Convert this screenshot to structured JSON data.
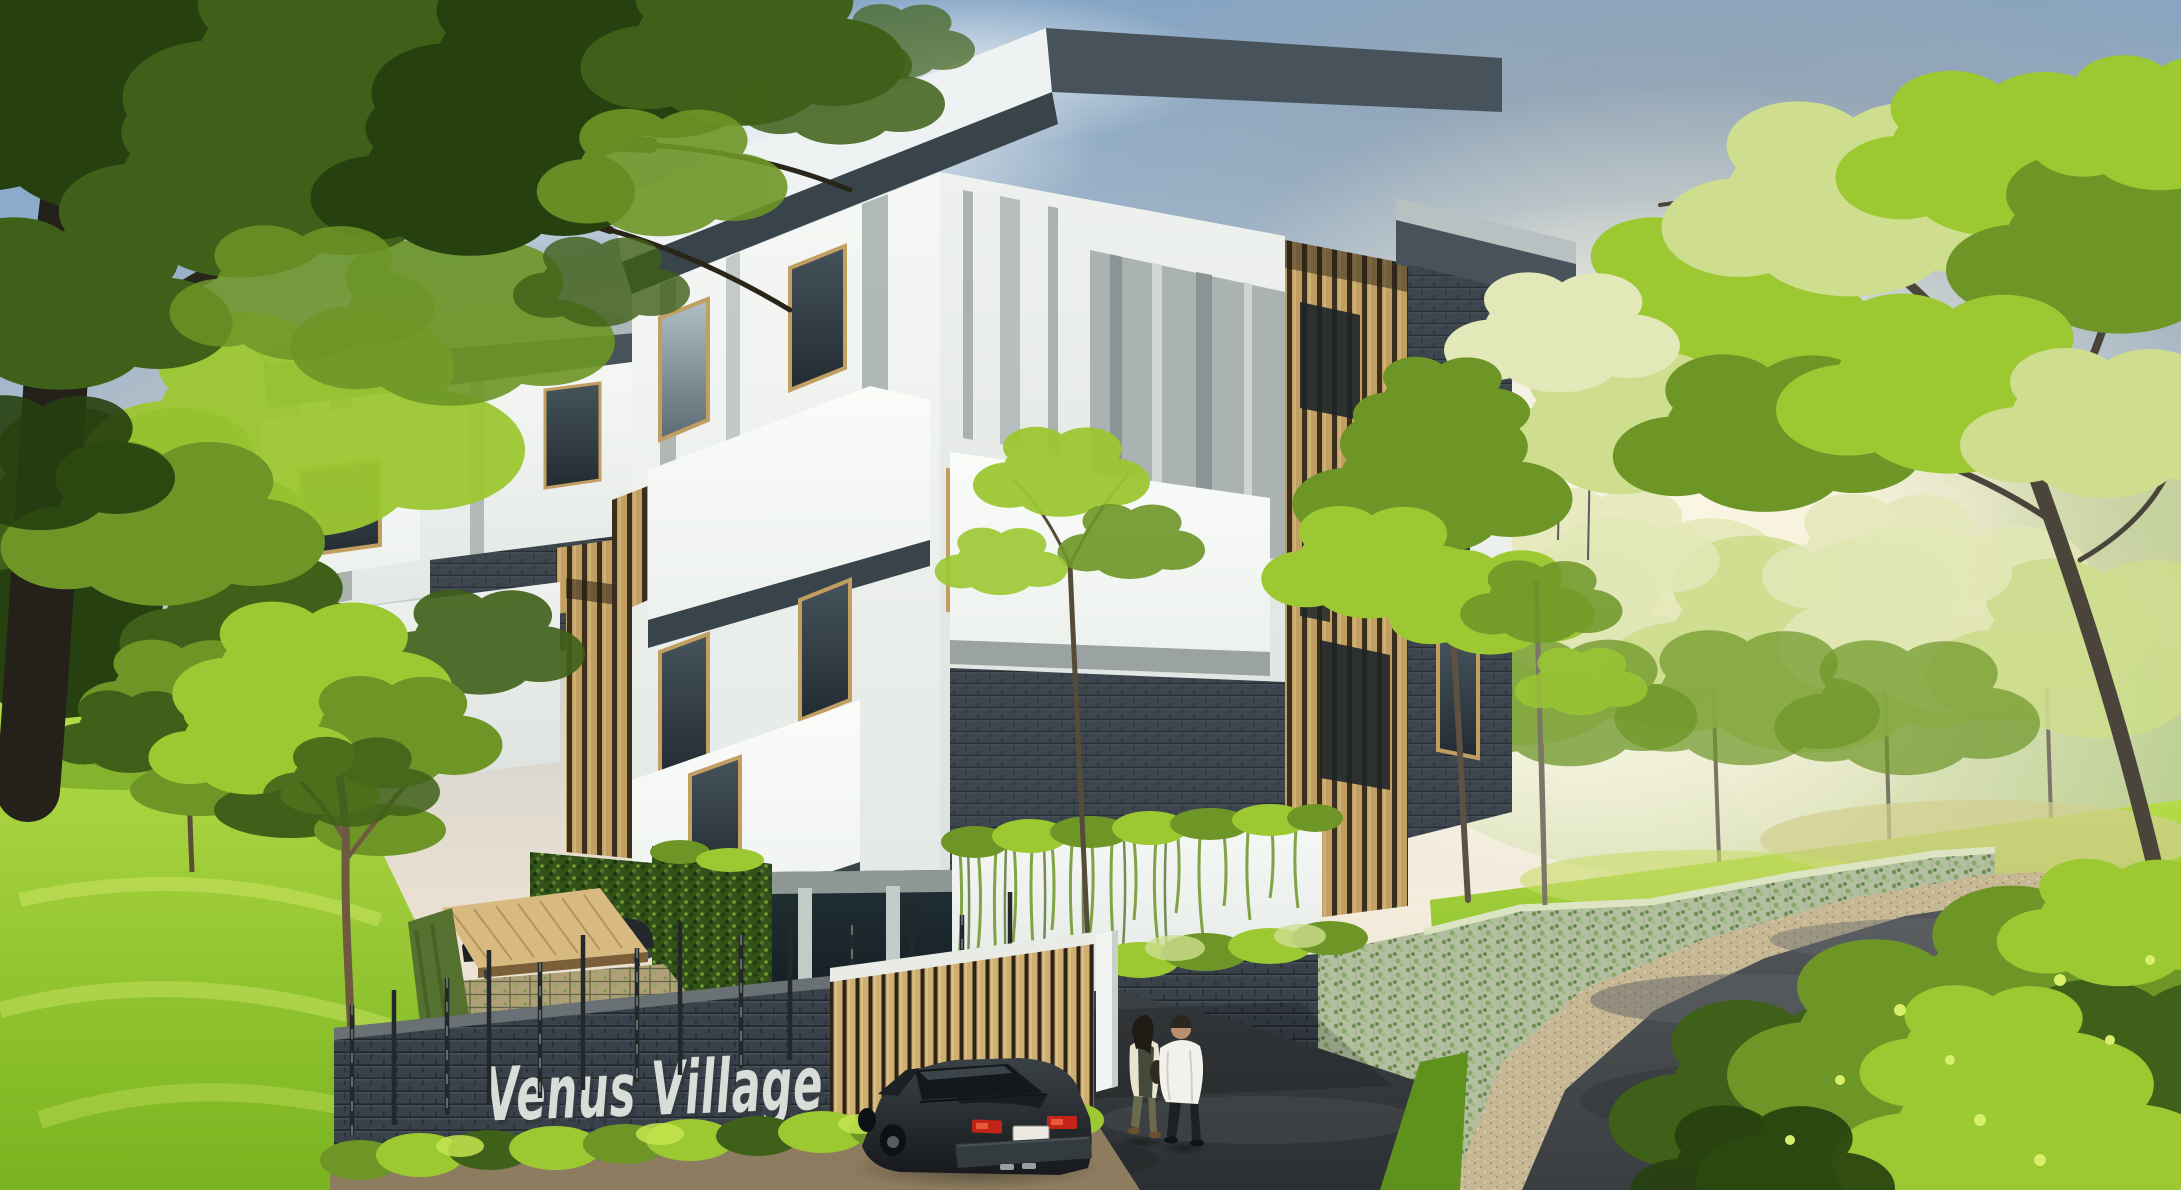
{
  "scene": {
    "title": "Venus Village residential complex - exterior architectural rendering",
    "sign_text": "Venus Village",
    "time_of_day": "daytime with hazy sun glow on the right"
  },
  "elements": [
    {
      "name": "sky",
      "desc": "blue sky upper-left fading to warm grey haze"
    },
    {
      "name": "clouds",
      "desc": "white and pink soft clouds"
    },
    {
      "name": "sun-haze",
      "desc": "bright warm glow washing the right side"
    },
    {
      "name": "main-apartment-building",
      "desc": "modern 5-storey block, white panels, charcoal brick, timber slat screens, overhanging dark roofs"
    },
    {
      "name": "second-apartment-building",
      "desc": "matching block behind trees at left"
    },
    {
      "name": "timber-slat-tower",
      "desc": "full-height vertical wood batten screen"
    },
    {
      "name": "balconies",
      "desc": "timber slat railings on white boxes"
    },
    {
      "name": "pilotis-pool",
      "desc": "open ground floor with columns and blue swimming pool"
    },
    {
      "name": "green-living-walls",
      "desc": "hedge walls and trailing vines on white planter"
    },
    {
      "name": "entrance-planter",
      "desc": "charcoal brick planter with hedge top"
    },
    {
      "name": "front-brick-fence",
      "desc": "dark grey brick fence with metal project sign"
    },
    {
      "name": "project-sign",
      "desc": "silver 3D letters reading Venus Village"
    },
    {
      "name": "timber-gate",
      "desc": "vertical wood slat gate beside white pillar"
    },
    {
      "name": "carport",
      "desc": "tan canopy sheltering two dark parked cars"
    },
    {
      "name": "sedan-car",
      "desc": "dark sedan on the driveway, rear view, red taillights, white plate"
    },
    {
      "name": "pedestrians",
      "desc": "two people walking toward entrance, one in white jacket, one with dark vest and olive trousers"
    },
    {
      "name": "driveway",
      "desc": "dark asphalt drive inside the gate"
    },
    {
      "name": "curved-road",
      "desc": "asphalt road with gravel edge curving around vine-covered hedge wall"
    },
    {
      "name": "lawns",
      "desc": "bright green sloping grass"
    },
    {
      "name": "trees",
      "desc": "large foreground tree upper-left, small garden trees, sunlit trees on the right"
    },
    {
      "name": "foreground-bushes",
      "desc": "glossy green shrubs bottom-right"
    }
  ],
  "palette": {
    "skyTop": "#84a5c6",
    "skyMid": "#c7cdcb",
    "skyWarm": "#efe4d2",
    "skyBlue": "#6f9fd0",
    "cloud": "#f4f6f7",
    "hazeCore": "#fdfbee",
    "pink": "#e6d0c6",
    "greyCloud": "#97a3ad",
    "foliageDarkest": "#26400f",
    "foliageDark": "#3f6018",
    "foliageMid": "#6d9627",
    "foliageBright": "#9cc832",
    "foliageSunlit": "#cedd8e",
    "foliagePale": "#e3e8b8",
    "trunkDark": "#2a2519",
    "trunkMid": "#58503c",
    "trunkGrey": "#7c7668",
    "wallWhite": "#f2f4f1",
    "wallShade": "#d7ddd9",
    "panelGrey": "#aab3b1",
    "stripeGrey": "#8e9997",
    "fasciaDark": "#47525a",
    "soffit": "#39434a",
    "brick": "#3d464e",
    "brickLight": "#4d565e",
    "wood": "#c19e62",
    "woodLight": "#d8ba80",
    "woodGap": "#3a2e1c",
    "glass": "#2c363c",
    "pool": "#2b7a8c",
    "poolLight": "#6fc4cf",
    "asphalt": "#46494b",
    "asphaltDark": "#33383a",
    "asphaltLight": "#5b5f61",
    "gravel": "#c6b894",
    "soil": "#8d7c5f",
    "grass": "#8abf28",
    "grassLight": "#abd63c",
    "grassDark": "#5f921c",
    "hedge": "#33511b",
    "vine": "#b4bfa2",
    "sign": "#d8ddd8",
    "signShadow": "#32373c",
    "carBody": "#2e3437",
    "carDarker": "#1b2023",
    "tailRed": "#c22417",
    "plate": "#eceae2",
    "jacketWhite": "#f2f1ec",
    "vestDark": "#3c4034",
    "pantsOlive": "#6c6a4d",
    "pantsBlack": "#1e2124",
    "skin": "#b98f6d"
  }
}
